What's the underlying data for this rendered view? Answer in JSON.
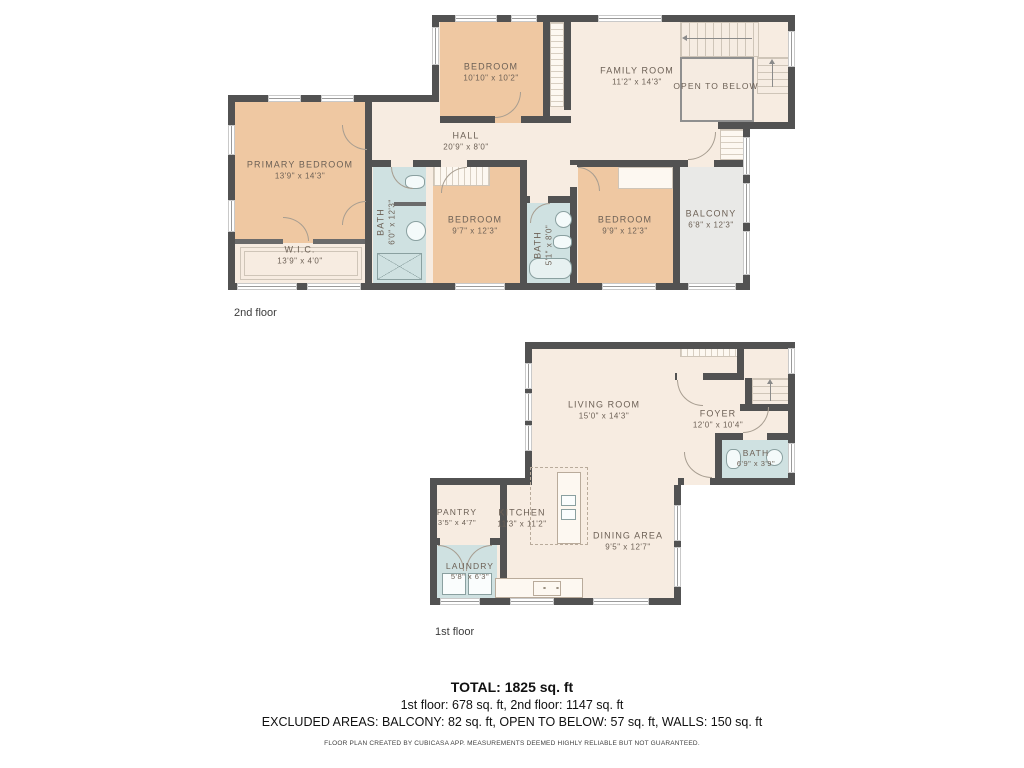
{
  "floors": [
    {
      "label": "2nd floor",
      "rooms": [
        {
          "name": "BEDROOM",
          "dims": "10'10\" x 10'2\""
        },
        {
          "name": "FAMILY ROOM",
          "dims": "11'2\" x 14'3\""
        },
        {
          "name": "OPEN TO BELOW",
          "dims": ""
        },
        {
          "name": "HALL",
          "dims": "20'9\" x 8'0\""
        },
        {
          "name": "PRIMARY BEDROOM",
          "dims": "13'9\" x 14'3\""
        },
        {
          "name": "W.I.C.",
          "dims": "13'9\" x 4'0\""
        },
        {
          "name": "BATH",
          "dims": "6'0\" x 12'3\""
        },
        {
          "name": "BEDROOM",
          "dims": "9'7\" x 12'3\""
        },
        {
          "name": "BATH",
          "dims": "5'1\" x 8'0\""
        },
        {
          "name": "BEDROOM",
          "dims": "9'9\" x 12'3\""
        },
        {
          "name": "BALCONY",
          "dims": "6'8\" x 12'3\""
        }
      ]
    },
    {
      "label": "1st floor",
      "rooms": [
        {
          "name": "LIVING ROOM",
          "dims": "15'0\" x 14'3\""
        },
        {
          "name": "FOYER",
          "dims": "12'0\" x 10'4\""
        },
        {
          "name": "BATH",
          "dims": "6'9\" x 3'9\""
        },
        {
          "name": "PANTRY",
          "dims": "3'5\" x 4'7\""
        },
        {
          "name": "KITCHEN",
          "dims": "11'3\" x 11'2\""
        },
        {
          "name": "LAUNDRY",
          "dims": "5'8\" x 6'3\""
        },
        {
          "name": "DINING AREA",
          "dims": "9'5\" x 12'7\""
        }
      ]
    }
  ],
  "summary": {
    "total": "TOTAL: 1825 sq. ft",
    "floors_line": "1st floor: 678 sq. ft, 2nd floor: 1147 sq. ft",
    "excluded_line": "EXCLUDED AREAS: BALCONY: 82 sq. ft, OPEN TO BELOW: 57 sq. ft, WALLS: 150 sq. ft",
    "disclaimer": "FLOOR PLAN CREATED BY CUBICASA APP. MEASUREMENTS DEEMED HIGHLY RELIABLE BUT NOT GUARANTEED."
  },
  "colors": {
    "wall": "#525252",
    "floor_cream": "#f7ece1",
    "bedroom_peach": "#efc8a2",
    "bath_blue": "#cfe1e1",
    "balcony_gray": "#e9e9e7",
    "label_text": "#6d6156"
  }
}
